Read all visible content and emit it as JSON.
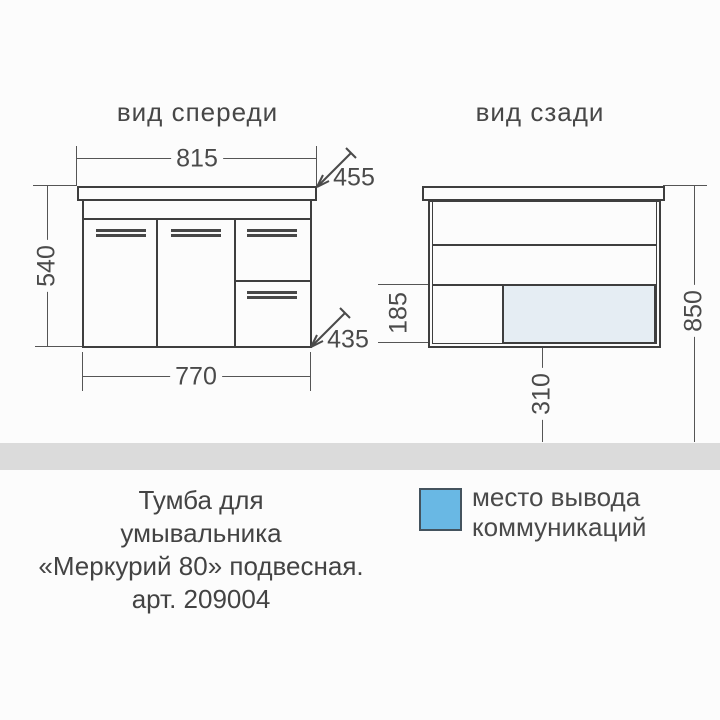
{
  "colors": {
    "background": "#fcfcfc",
    "line": "#3e3e3e",
    "text": "#474747",
    "floor_band": "#dbdbdb",
    "legend_blue": "#69b8e4",
    "outlet_area_fill": "#e5edf3"
  },
  "front_view": {
    "title": "вид спереди",
    "dim_top_width": "815",
    "dim_top_depth": "455",
    "dim_height": "540",
    "dim_bottom_depth": "435",
    "dim_bottom_width": "770"
  },
  "back_view": {
    "title": "вид сзади",
    "dim_outlet_zone_height": "185",
    "dim_total_height": "850",
    "dim_outlet_drop": "310"
  },
  "legend": {
    "label_line1": "место вывода",
    "label_line2": "коммуникаций"
  },
  "caption": {
    "line1": "Тумба для",
    "line2": "умывальника",
    "line3": "«Меркурий 80» подвесная.",
    "line4": "арт. 209004"
  }
}
